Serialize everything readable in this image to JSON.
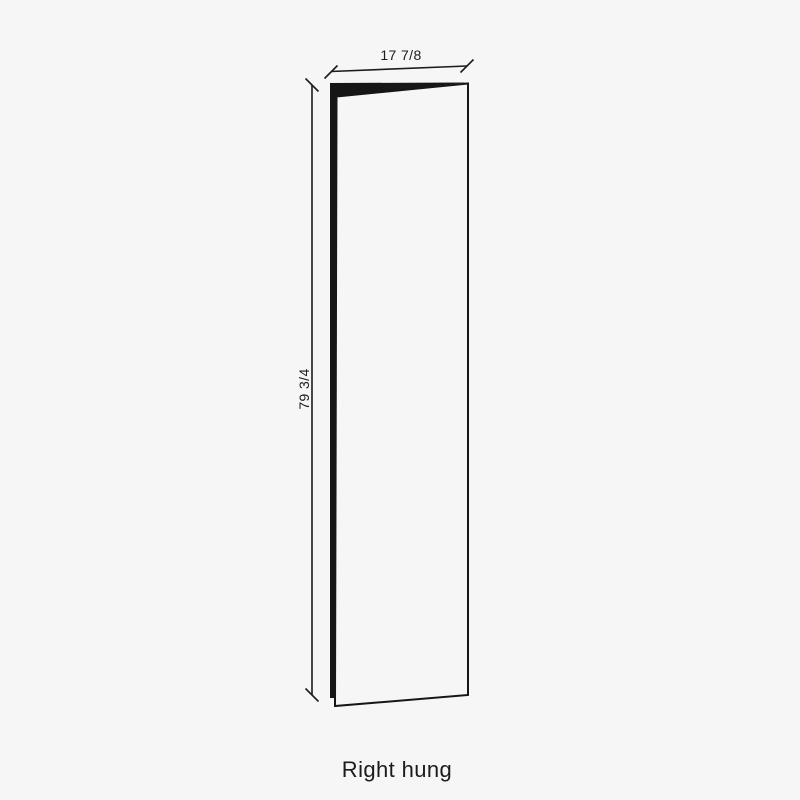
{
  "colors": {
    "background": "#f6f6f6",
    "line": "#161616",
    "text": "#1c1c1c"
  },
  "diagram": {
    "width_dimension": "17 7/8",
    "height_dimension": "79 3/4",
    "caption": "Right hung"
  }
}
